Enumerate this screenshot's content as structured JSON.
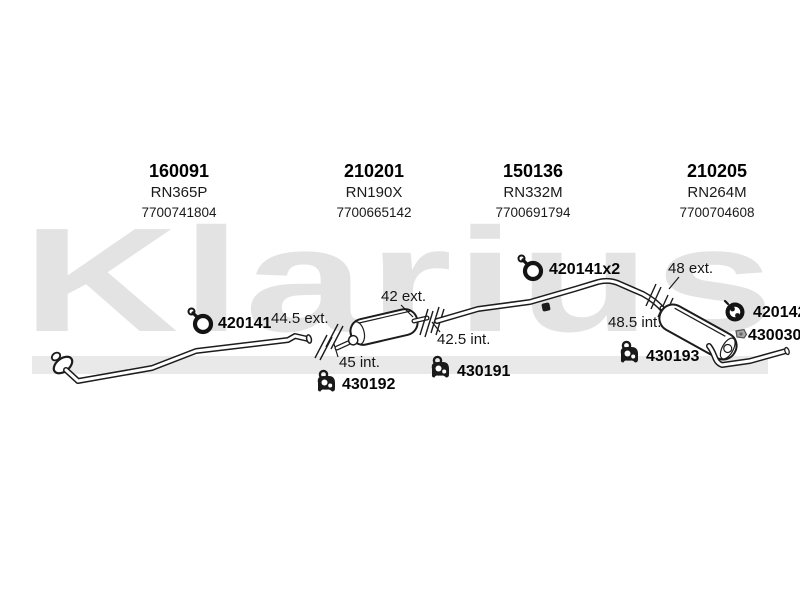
{
  "watermark": {
    "text": "Klarius"
  },
  "header_parts": [
    {
      "part_no": "160091",
      "ref": "RN365P",
      "oem": "7700741804"
    },
    {
      "part_no": "210201",
      "ref": "RN190X",
      "oem": "7700665142"
    },
    {
      "part_no": "150136",
      "ref": "RN332M",
      "oem": "7700691794"
    },
    {
      "part_no": "210205",
      "ref": "RN264M",
      "oem": "7700704608"
    }
  ],
  "labels": {
    "front_clamp": "420141",
    "front_pipe_ext": "44.5 ext.",
    "front_pipe_int": "45 int.",
    "mid_outlet_ext": "42 ext.",
    "mid_outlet_int": "42.5 int.",
    "mid_mount": "430192",
    "centre_mount": "430191",
    "centre_clamps": "420141x2",
    "rear_ext": "48 ext.",
    "rear_int": "48.5 int.",
    "rear_mount": "430193",
    "rear_clamp": "420142",
    "rear_olive": "430030"
  }
}
